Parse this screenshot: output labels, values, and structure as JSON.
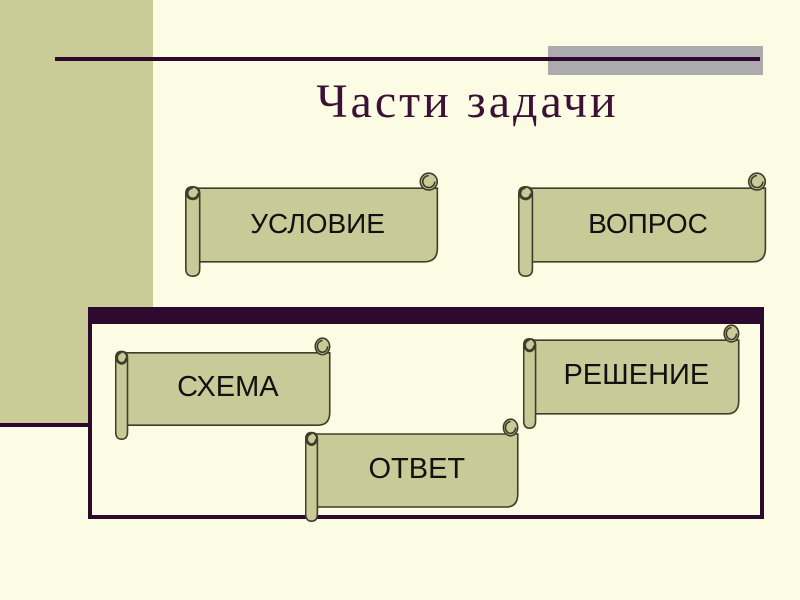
{
  "slide": {
    "title": "Части задачи"
  },
  "banners": [
    {
      "id": "uslovie",
      "label": "УСЛОВИЕ"
    },
    {
      "id": "vopros",
      "label": "ВОПРОС"
    },
    {
      "id": "shema",
      "label": "СХЕМА"
    },
    {
      "id": "reshenie",
      "label": "РЕШЕНИЕ"
    },
    {
      "id": "otvet",
      "label": "ОТВЕТ"
    }
  ],
  "colors": {
    "background": "#FCFCE4",
    "left_band": "#CBCB98",
    "accent_purple": "#2E092E",
    "title_text": "#3B1235",
    "gray_highlight": "#ABABAF",
    "scroll_fill": "#C8CA97",
    "scroll_outline": "#3E3E2C",
    "label_text": "#111111"
  }
}
